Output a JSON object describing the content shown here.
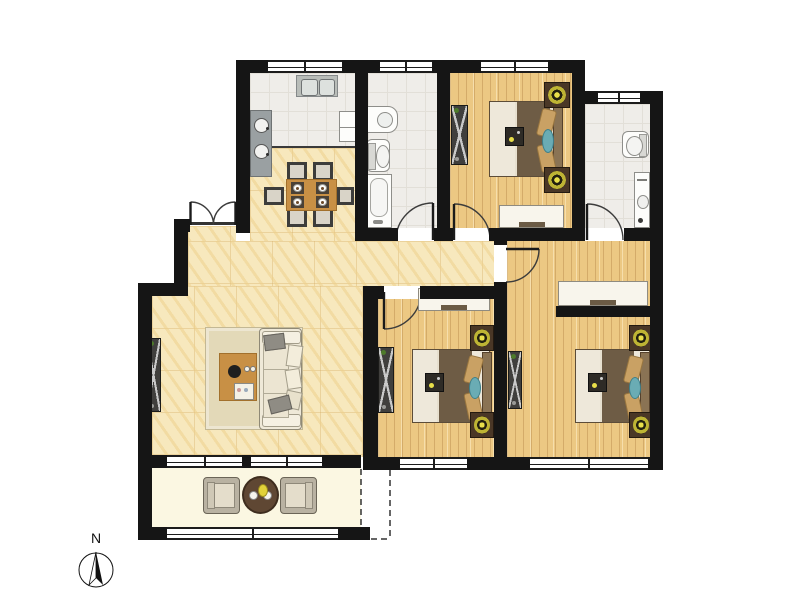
{
  "compass": {
    "label": "N"
  },
  "palette": {
    "wall": "#151515",
    "cream_floor": "#f7e8bd",
    "wood_floor": "#ecc883",
    "tile_floor": "#efede9",
    "balcony_floor": "#fbf7e2",
    "window_white": "#ffffff",
    "wood_furniture": "#c89045",
    "blanket_brown": "#6e5c45",
    "mattress_cream": "#eee8da",
    "pillow_tan": "#c9a164",
    "accent_teal": "#6aacb4",
    "lamp_yellow": "#e8df4a",
    "dark_cabinet": "#403f3d",
    "sofa_cream": "#efe9d8",
    "rug_beige": "#e3d9b8",
    "balcony_table_brown": "#5f4733"
  },
  "rooms": [
    {
      "id": "kitchen",
      "floor": "tile",
      "items": [
        "double-sink",
        "cooktop",
        "fridge"
      ]
    },
    {
      "id": "dining",
      "floor": "cream-tile",
      "items": [
        "dining-table",
        "6-chairs",
        "place-settings"
      ]
    },
    {
      "id": "bathroom-1",
      "floor": "tile",
      "items": [
        "washbasin",
        "toilet",
        "bathtub"
      ]
    },
    {
      "id": "bedroom-1",
      "floor": "wood",
      "items": [
        "double-bed",
        "wardrobe",
        "2-nightstand-lamps",
        "desk"
      ]
    },
    {
      "id": "bathroom-2",
      "floor": "tile",
      "items": [
        "toilet",
        "vanity-sink"
      ]
    },
    {
      "id": "living-room",
      "floor": "cream-tile",
      "items": [
        "sofa",
        "coffee-table",
        "rug",
        "tv-cabinet"
      ]
    },
    {
      "id": "hallway",
      "floor": "cream-tile",
      "items": []
    },
    {
      "id": "bedroom-2",
      "floor": "wood",
      "items": [
        "double-bed",
        "wardrobe",
        "2-nightstand-lamps",
        "desk"
      ]
    },
    {
      "id": "bedroom-3",
      "floor": "wood",
      "items": [
        "double-bed",
        "tv-cabinet",
        "2-nightstand-lamps",
        "desk"
      ]
    },
    {
      "id": "balcony",
      "floor": "pale-tile",
      "items": [
        "2-armchairs",
        "round-tea-table"
      ]
    }
  ]
}
